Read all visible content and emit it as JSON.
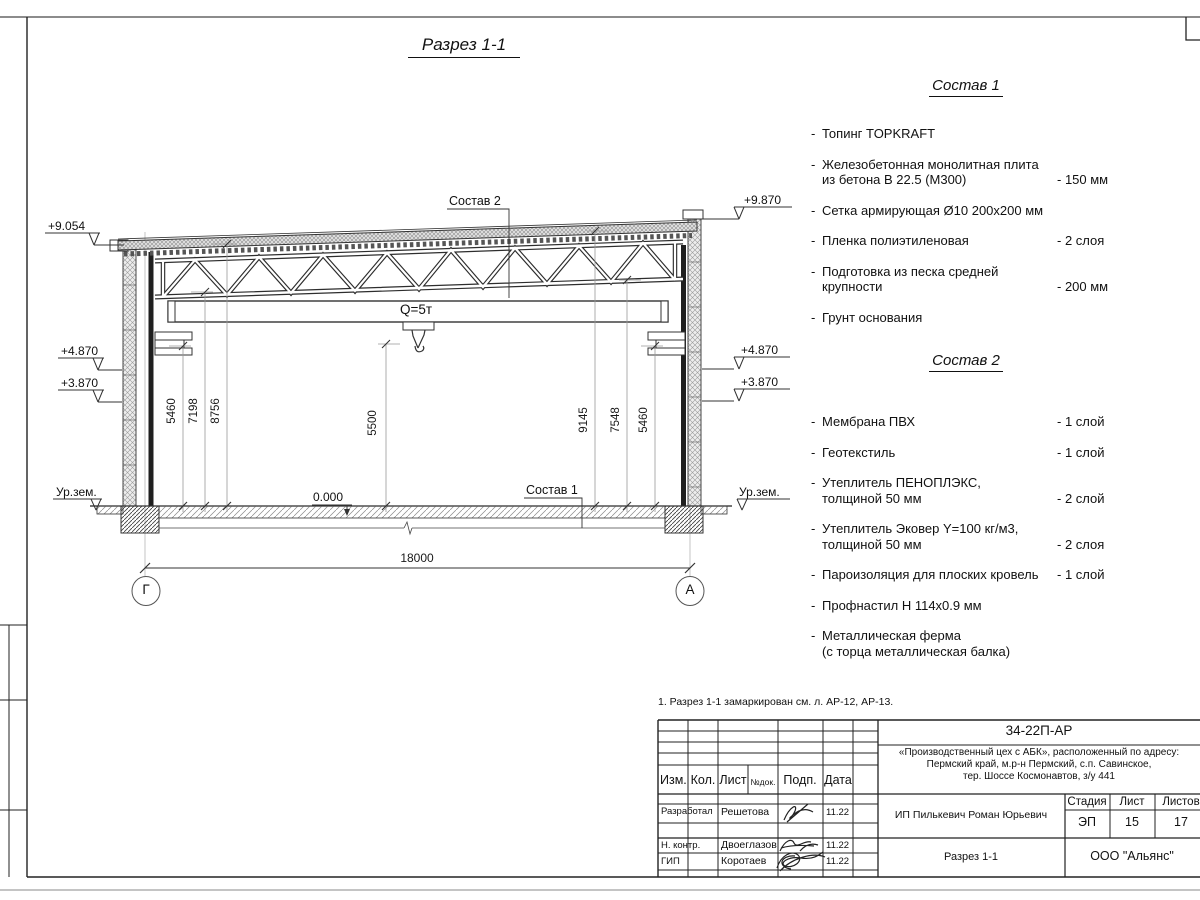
{
  "sheet": {
    "title": "Разрез 1-1",
    "note": "1. Разрез 1-1 замаркирован см. л. АР-12, АР-13."
  },
  "misc": {
    "bullet": "-"
  },
  "drawing": {
    "crane_capacity": "Q=5т",
    "level_zero": "0.000",
    "ground_level_left": "Ур.зем.",
    "ground_level_right": "Ур.зем.",
    "elev_left_top": "+9.054",
    "elev_left_mid": "+4.870",
    "elev_left_low": "+3.870",
    "elev_right_top": "+9.870",
    "elev_right_mid": "+4.870",
    "elev_right_low": "+3.870",
    "dim_left_1": "5460",
    "dim_left_2": "7198",
    "dim_left_3": "8756",
    "dim_mid": "5500",
    "dim_right_1": "9145",
    "dim_right_2": "7548",
    "dim_right_3": "5460",
    "dim_span": "18000",
    "axis_left": "Г",
    "axis_right": "А"
  },
  "sostav1": {
    "title": "Состав 1",
    "items": [
      {
        "text": "Топинг TOPKRAFT"
      },
      {
        "text": "Железобетонная  монолитная плита",
        "text2": "из бетона В 22.5 (М300)",
        "value": "- 150 мм"
      },
      {
        "text": "Сетка армирующая Ø10 200х200 мм"
      },
      {
        "text": "Пленка полиэтиленовая",
        "value": "- 2 слоя"
      },
      {
        "text": "Подготовка из песка средней",
        "text2": "крупности",
        "value": "- 200 мм"
      },
      {
        "text": "Грунт основания"
      }
    ]
  },
  "sostav2": {
    "title": "Состав 2",
    "items": [
      {
        "text": "Мембрана ПВХ",
        "value": "- 1 слой"
      },
      {
        "text": "Геотекстиль",
        "value": "- 1 слой"
      },
      {
        "text": "Утеплитель ПЕНОПЛЭКС,",
        "text2": "толщиной 50 мм",
        "value": "- 2 слой"
      },
      {
        "text": "Утеплитель Эковер Y=100 кг/м3,",
        "text2": "толщиной 50 мм",
        "value": "- 2 слоя"
      },
      {
        "text": "Пароизоляция для плоских кровель",
        "value": "- 1 слой"
      },
      {
        "text": "Профнастил Н 114х0.9 мм"
      },
      {
        "text": "Металлическая ферма",
        "text2": "(с торца металлическая балка)"
      }
    ]
  },
  "titleblock": {
    "doc_number": "34-22П-АР",
    "project_address_1": "«Производственный цех с АБК», расположенный по адресу:",
    "project_address_2": "Пермский край, м.р-н Пермский, с.п. Савинское,",
    "project_address_3": "тер. Шоссе Космонавтов, з/у 441",
    "client": "ИП Пилькевич Роман Юрьевич",
    "sheet_name": "Разрез 1-1",
    "company": "ООО \"Альянс\"",
    "stage_label": "Стадия",
    "list_label": "Лист",
    "listov_label": "Листов",
    "stage_value": "ЭП",
    "list_value": "15",
    "listov_value": "17",
    "col_izm": "Изм.",
    "col_kol": "Кол.",
    "col_list": "Лист",
    "col_ndok": "№док.",
    "col_podp": "Подп.",
    "col_data": "Дата",
    "row1_role": "Разработал",
    "row1_name": "Решетова",
    "row1_date": "11.22",
    "row2_role": "Н. контр.",
    "row2_name": "Двоеглазов",
    "row2_date": "11.22",
    "row3_role": "ГИП",
    "row3_name": "Коротаев",
    "row3_date": "11.22"
  }
}
